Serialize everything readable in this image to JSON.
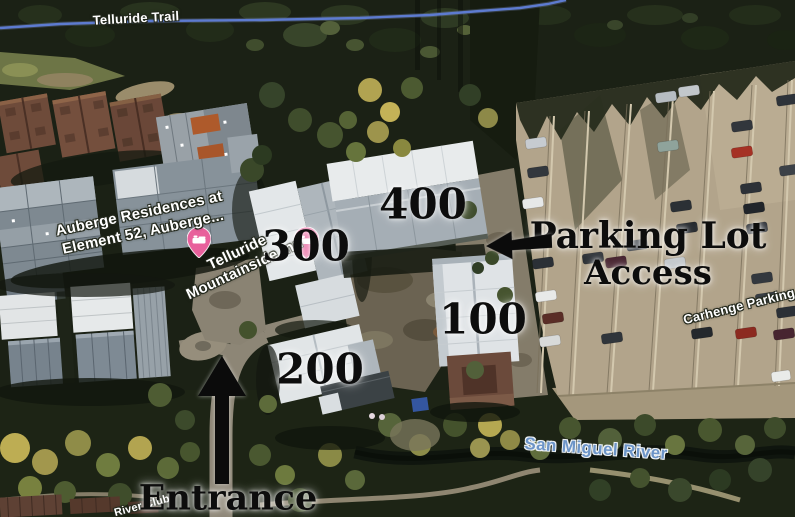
{
  "map_labels": {
    "trail": "Telluride Trail",
    "resort": {
      "line1": "Auberge Residences at",
      "line2": "Element 52, Auberge..."
    },
    "inn": {
      "line1": "Telluride",
      "line2": "Mountainside Inn"
    },
    "parking_name": "Carhenge Parking",
    "river": "San Miguel River",
    "river_club": "River Club"
  },
  "annotations": {
    "buildings": [
      {
        "id": "building-400",
        "label": "400"
      },
      {
        "id": "building-300",
        "label": "300"
      },
      {
        "id": "building-100",
        "label": "100"
      },
      {
        "id": "building-200",
        "label": "200"
      }
    ],
    "parking_access": {
      "line1": "Parking Lot",
      "line2": "Access"
    },
    "entrance": "Entrance"
  },
  "icons": {
    "lodging_pin_main": "lodging-pin",
    "lodging_pin_300": "lodging-pin",
    "entrance_arrow": "up-arrow",
    "parking_access_arrow": "left-arrow"
  },
  "colors": {
    "trail_line": "#5d7bd0",
    "water_label_text": "#6d95c8",
    "annotation_text": "#0d0d0d",
    "lodging_pin_pink": "#e8609c",
    "parking_lot_ground": "#b2a48b"
  }
}
